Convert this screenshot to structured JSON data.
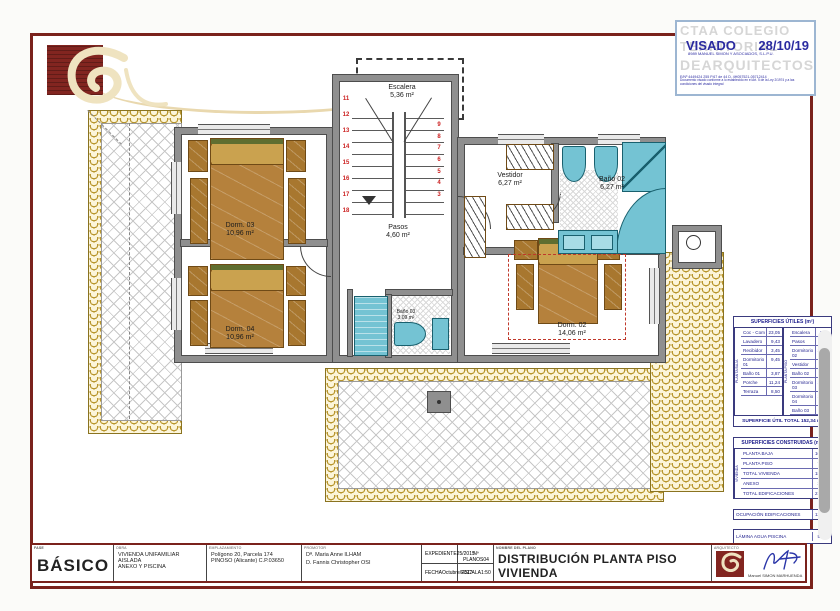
{
  "stamp": {
    "org_top": "CTAA COLEGIO",
    "org_mid": "TERRITORIAL",
    "org_bottom": "DEARQUITECTOS",
    "visado_label": "VISADO",
    "visado_date": "28/10/19",
    "firm": "8989 MANUEL SIMON Y ASOCIADOS, S.L.P.U.",
    "refs": "E/Nº 4449424 255    P.67 de 44    D. 4H057521-05712414",
    "note": "Documento visado conforme a lo establecido en el Art. 5 de la Ley 2/1974 y a las condiciones del visado integral"
  },
  "plan": {
    "rooms": {
      "escalera": {
        "label": "Escalera",
        "area": "5,36 m²"
      },
      "pasos": {
        "label": "Pasos",
        "area": "4,60 m²"
      },
      "vestidor": {
        "label": "Vestidor",
        "area": "6,27 m²"
      },
      "bano02": {
        "label": "Baño 02",
        "area": "6,27 m²"
      },
      "dorm02": {
        "label": "Dorm. 02",
        "area": "14,06 m²"
      },
      "dorm03": {
        "label": "Dorm. 03",
        "area": "10,96 m²"
      },
      "dorm04": {
        "label": "Dorm. 04",
        "area": "10,96 m²"
      },
      "bano03": {
        "label": "Baño 03",
        "area": "3,09 m²"
      }
    },
    "stairs": {
      "left": [
        "11",
        "12",
        "13",
        "14",
        "15",
        "16",
        "17",
        "18"
      ],
      "right": [
        "9",
        "8",
        "7",
        "6",
        "5",
        "4",
        "3"
      ]
    }
  },
  "tables": {
    "utiles": {
      "title": "SUPERFICIES ÚTILES (m²)",
      "left_group": "PLANTA BAJA",
      "right_group": "PLANTA PISO",
      "left": [
        {
          "name": "Coc - Com",
          "value": "23,05"
        },
        {
          "name": "Lavadero",
          "value": "9,43"
        },
        {
          "name": "Recibidor",
          "value": "3,45"
        },
        {
          "name": "Dormitorio 01",
          "value": "9,45"
        },
        {
          "name": "Baño 01",
          "value": "3,87"
        },
        {
          "name": "Porche",
          "value": "11,24"
        },
        {
          "name": "Terraza",
          "value": "8,50"
        }
      ],
      "right": [
        {
          "name": "Escalera",
          "value": "5,36"
        },
        {
          "name": "Pasos",
          "value": "4,60"
        },
        {
          "name": "Dormitorio 02",
          "value": "14,06"
        },
        {
          "name": "Vestidor",
          "value": "6,27"
        },
        {
          "name": "Baño 02",
          "value": "6,27"
        },
        {
          "name": "Dormitorio 03",
          "value": "10,96"
        },
        {
          "name": "Dormitorio 04",
          "value": "10,96"
        },
        {
          "name": "Baño 03",
          "value": "3,09"
        }
      ],
      "total": "SUPERFICIE ÚTIL TOTAL  152,34 m²"
    },
    "construidas": {
      "title": "SUPERFICIES CONSTRUIDAS (m²)",
      "group": "VIVIENDA",
      "rows": [
        {
          "name": "PLANTA BAJA",
          "value": "106,83"
        },
        {
          "name": "PLANTA PISO",
          "value": "73,74"
        },
        {
          "name": "TOTAL VIVIENDA",
          "value": "180,57"
        },
        {
          "name": "ANEXO",
          "value": "35,00"
        },
        {
          "name": "TOTAL EDIFICACIONES",
          "value": "215,57"
        }
      ],
      "ocupacion": {
        "name": "OCUPACIÓN EDIFICACIONES",
        "value": "135,30"
      },
      "lamina": {
        "name": "LÁMINA AGUA PISCINA",
        "value": "50,00"
      }
    }
  },
  "titleblock": {
    "fase_header": "FASE",
    "fase": "BÁSICO",
    "obra_header": "OBRA",
    "obra_line1": "VIVIENDA UNIFAMILIAR AISLADA",
    "obra_line2": "ANEXO Y PISCINA",
    "situacion_header": "EMPLAZAMIENTO",
    "situacion_line1": "Polígono 20, Parcela 174",
    "situacion_line2": "PINOSO (Alicante) C.P.03650",
    "promotor_header": "PROMOTOR",
    "promotor_line1": "Dª. Maria Anne ILHAM",
    "promotor_line2": "D. Fannis Christopher OSI",
    "expediente_header": "EXPEDIENTE",
    "expediente": "25/2015",
    "nplano_header": "Nº PLANOS",
    "nplano": "04",
    "fecha_header": "FECHA",
    "fecha": "Octubre/2017",
    "escala_header": "ESCALA",
    "escala": "1:50",
    "nombre_header": "NOMBRE DEL PLANO",
    "nombre": "DISTRIBUCIÓN PLANTA PISO VIVIENDA",
    "arquitecto_header": "ARQUITECTO",
    "arquitecto": "Manuel SIMON MARHUENDA"
  }
}
